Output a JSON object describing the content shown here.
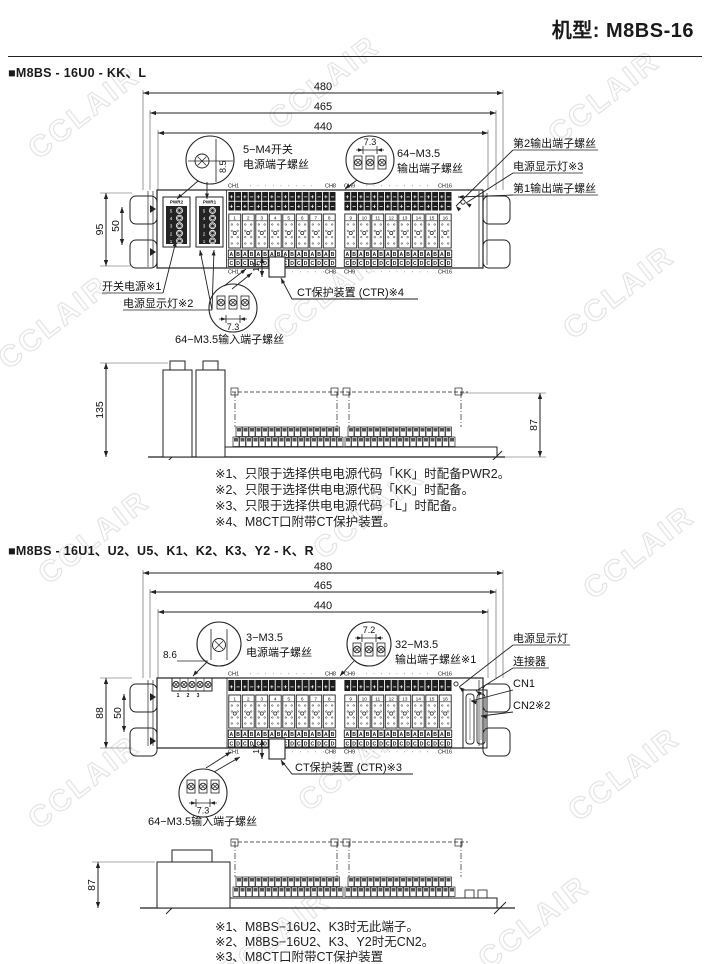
{
  "header": {
    "model_label": "机型: M8BS-16"
  },
  "watermark": {
    "text": "CCLAIR"
  },
  "shared": {
    "polarity": [
      "+",
      "−"
    ],
    "ab": [
      "A",
      "B"
    ],
    "cd": [
      "C",
      "D"
    ],
    "channel_numbers": [
      "1",
      "2",
      "3",
      "4",
      "5",
      "6",
      "7",
      "8",
      "9",
      "10",
      "11",
      "12",
      "13",
      "14",
      "15",
      "16"
    ],
    "ch_labels": {
      "ch1": "CH1",
      "ch8": "CH8",
      "ch9": "CH9",
      "ch16": "CH16"
    },
    "dots": "· · · · · · · · ·",
    "dots_short": "· · · · ·"
  },
  "section1": {
    "title": "■M8BS - 16U0 - KK、L",
    "dims": {
      "w480": "480",
      "w465": "465",
      "w440": "440",
      "h95": "95",
      "h50": "50",
      "s8_5": "8.5",
      "p7_3_out": "7.3",
      "v17": "17",
      "p7_3_in": "7.3",
      "side_h135": "135",
      "side_h87": "87"
    },
    "pwr2": {
      "label": "PWR2",
      "terminals": [
        "5",
        "4",
        "3",
        "2",
        "1"
      ]
    },
    "pwr1": {
      "label": "PWR1",
      "terminals": [
        "5",
        "4",
        "3",
        "2",
        "1"
      ]
    },
    "callout_switch_power": [
      "5−M4开关",
      "电源端子螺丝"
    ],
    "callout_output": [
      "64−M3.5",
      "输出端子螺丝"
    ],
    "callout_input": "64−M3.5输入端子螺丝",
    "label_ct": "CT保护装置 (CTR)※4",
    "label_out2": "第2输出端子螺丝",
    "label_lamp3": "电源显示灯※3",
    "label_out1": "第1输出端子螺丝",
    "label_switch_power": "开关电源※1",
    "label_lamp2": "电源显示灯※2",
    "notes": [
      "※1、只限于选择供电电源代码「KK」时配备PWR2。",
      "※2、只限于选择供电电源代码「KK」时配备。",
      "※3、只限于选择供电电源代码「L」时配备。",
      "※4、M8CT口附带CT保护装置。"
    ]
  },
  "section2": {
    "title": "■M8BS - 16U1、U2、U5、K1、K2、K3、Y2 - K、R",
    "dims": {
      "w480": "480",
      "w465": "465",
      "w440": "440",
      "h88": "88",
      "h50": "50",
      "s8_6": "8.6",
      "p7_2": "7.2",
      "v17": "17",
      "p7_3_in": "7.3",
      "side_h87": "87"
    },
    "power_terminal_numbers": [
      "1",
      "2",
      "3"
    ],
    "callout_power": [
      "3−M3.5",
      "电源端子螺丝"
    ],
    "callout_output": [
      "32−M3.5",
      "输出端子螺丝※1"
    ],
    "callout_input": "64−M3.5输入端子螺丝",
    "label_ct": "CT保护装置 (CTR)※3",
    "label_lamp": "电源显示灯",
    "label_connector": "连接器",
    "label_cn1": "CN1",
    "label_cn2": "CN2※2",
    "notes": [
      "※1、M8BS−16U2、K3时无此端子。",
      "※2、M8BS−16U2、K3、Y2时无CN2。",
      "※3、M8CT口附带CT保护装置"
    ]
  }
}
